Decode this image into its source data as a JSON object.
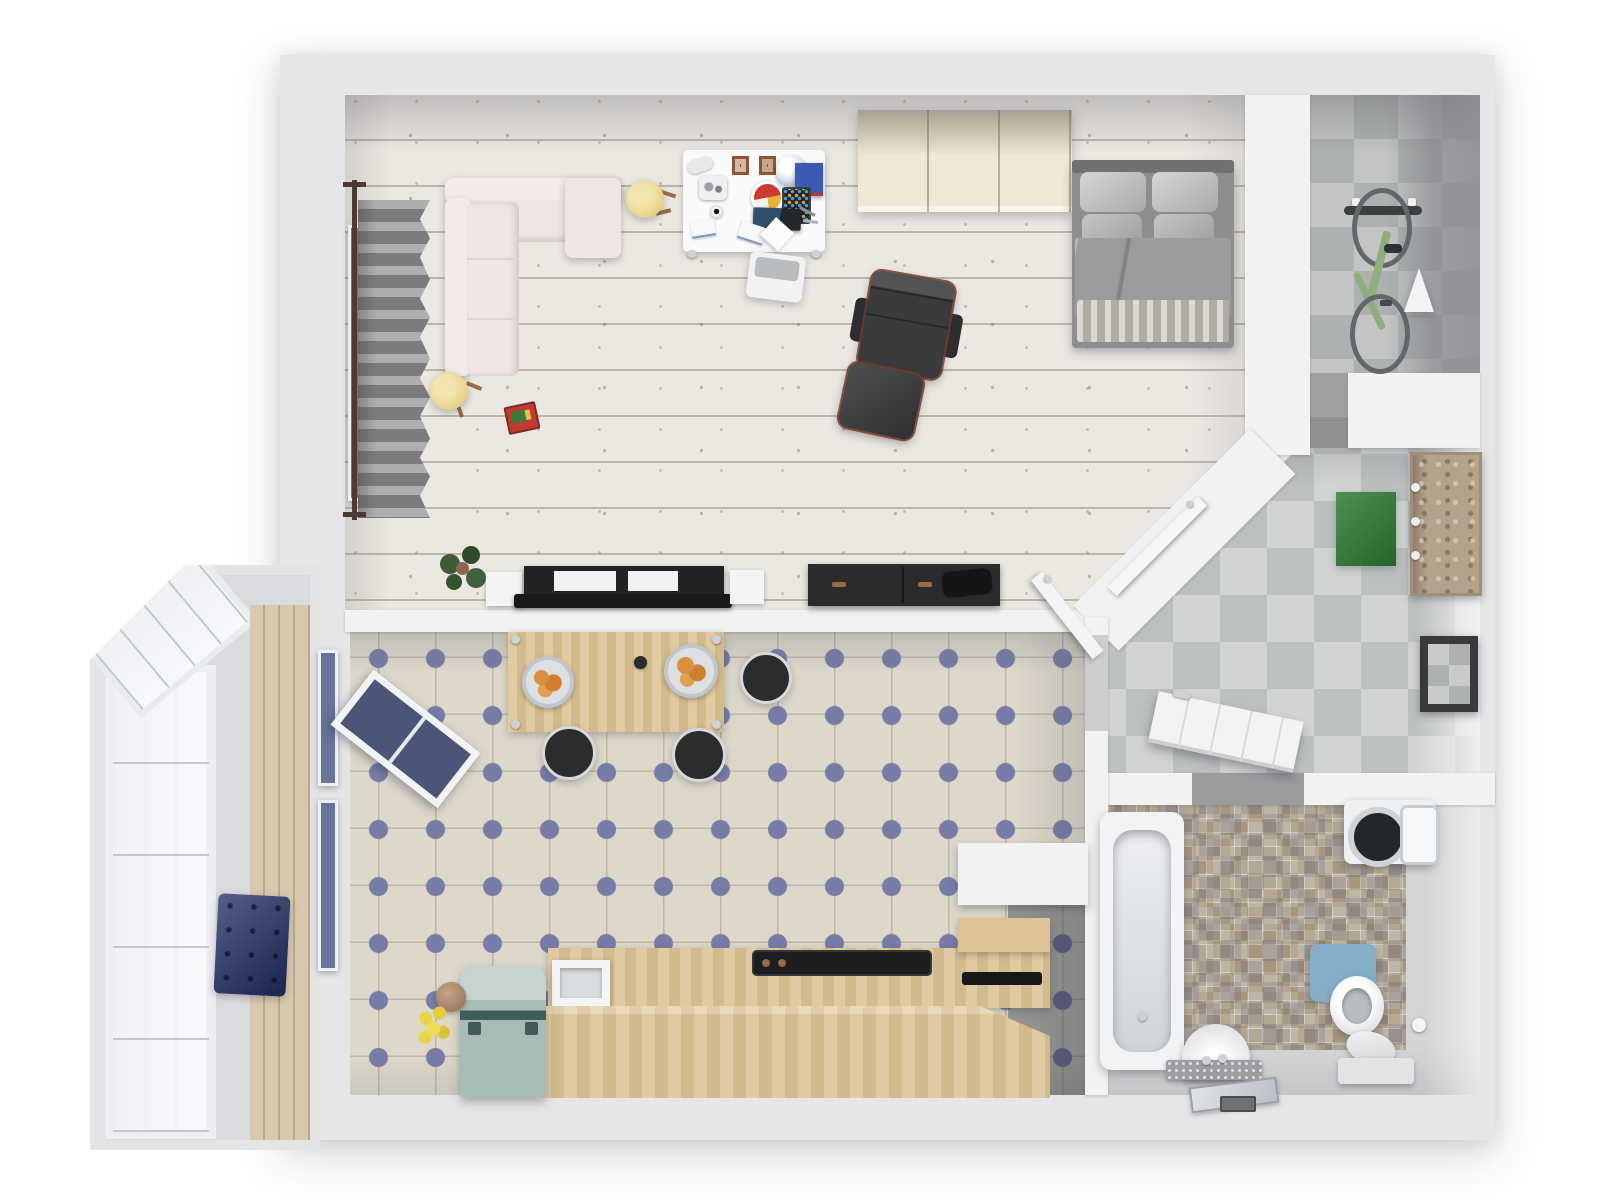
{
  "scene": {
    "type": "apartment-floor-plan-3d-render",
    "view": "top-down",
    "width_px": 1600,
    "height_px": 1200
  },
  "palette": {
    "background": "#ffffff",
    "outer_wall": "#e6e6e8",
    "inner_wall": "#f2f2f3",
    "wood_floor": "#ebe8e2",
    "hall_tile_light": "#d2d4d4",
    "hall_tile_dark": "#bdc0c0",
    "kitchen_tile_base": "#ddd8ca",
    "kitchen_tile_dot": "#767ca6",
    "bathroom_mosaic": "#b1a795",
    "bathroom_floor": "#d4d5d6",
    "balcony_wood_wall": "#d6c9ae",
    "sofa": "#efe5e5",
    "sofa_back": "#f3eaea",
    "bed_duvet": "#9b9b9d",
    "bed_blanket": "#c7c3ba",
    "wardrobe": "#efe8d6",
    "desk": "#fafafa",
    "lounge_chair": "#3a3b3d",
    "lounge_chair_trim": "#7a3b28",
    "tv_unit": "#232325",
    "dresser": "#2b2b2d",
    "counter_wood": "#dcc497",
    "table_wood": "#dcc496",
    "stool": "#2b2c2e",
    "fridge": "#a7bcb6",
    "bench": "#22306a",
    "doormat": "#2f7d33",
    "toilet_mat": "#85aec9",
    "bike_frame": "#8fae7d",
    "pouf": "#e9d68e",
    "curtain": "#97979a",
    "window_glass": "#67739a"
  },
  "rooms": {
    "living_room": {
      "label": "living-room-bedroom",
      "floor": "whitewashed-wood-planks",
      "furniture": [
        "corner-sofa",
        "curtain",
        "window",
        "pouf",
        "pouf",
        "game-box",
        "desk",
        "desk-chair",
        "desk-lamp",
        "globe",
        "tablet",
        "laptop",
        "wardrobe",
        "double-bed",
        "lounge-chair",
        "ottoman",
        "tv-sideboard",
        "speaker",
        "speaker",
        "dresser",
        "potted-plant",
        "door-to-hallway"
      ]
    },
    "kitchen": {
      "label": "kitchen",
      "floor": "cream-tiles-blue-diamonds",
      "furniture": [
        "dining-table",
        "fruit-bowl",
        "fruit-bowl",
        "stool",
        "stool",
        "stool",
        "fridge",
        "sink",
        "cooktop",
        "counter",
        "island-counter",
        "flower-vase",
        "open-window",
        "door"
      ]
    },
    "hallway": {
      "label": "entry-hall",
      "floor": "gray-checker-tiles",
      "furniture": [
        "doormat",
        "coat-rack",
        "mirror",
        "bathroom-door"
      ]
    },
    "storage_alcove": {
      "label": "storage-alcove",
      "floor": "gray-checker-tiles",
      "furniture": [
        "bicycle",
        "pendant-lamp"
      ]
    },
    "bathroom": {
      "label": "bathroom",
      "floor": "mosaic-and-gray",
      "furniture": [
        "bathtub",
        "washing-machine",
        "toilet",
        "toilet-mat",
        "pedestal-sink",
        "vanity-tray",
        "toilet-paper-holder"
      ]
    },
    "balcony": {
      "label": "balcony",
      "floor": "gray",
      "furniture": [
        "glazed-window-wall",
        "wood-panel-wall",
        "tufted-bench"
      ]
    }
  }
}
